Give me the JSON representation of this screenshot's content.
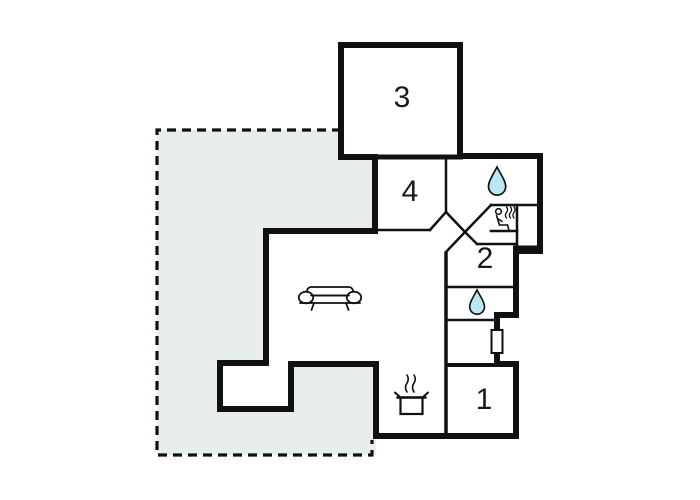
{
  "page": {
    "title": "Holiday home floor plan"
  },
  "colors": {
    "wall": "#111111",
    "floor": "#ffffff",
    "terrace_fill": "#e7edea",
    "water": "#b9e7f2",
    "label": "#1a1a1a",
    "background": "#ffffff"
  },
  "rooms": {
    "room1": {
      "label": "1"
    },
    "room2": {
      "label": "2"
    },
    "room3": {
      "label": "3"
    },
    "room4": {
      "label": "4"
    }
  },
  "icons": {
    "sofa": "sofa-icon",
    "stove": "stove-pot-icon",
    "bathroom_upper": "water-drop-icon",
    "bathroom_lower": "water-drop-icon",
    "sauna": "sauna-person-icon",
    "window": "window-symbol"
  }
}
